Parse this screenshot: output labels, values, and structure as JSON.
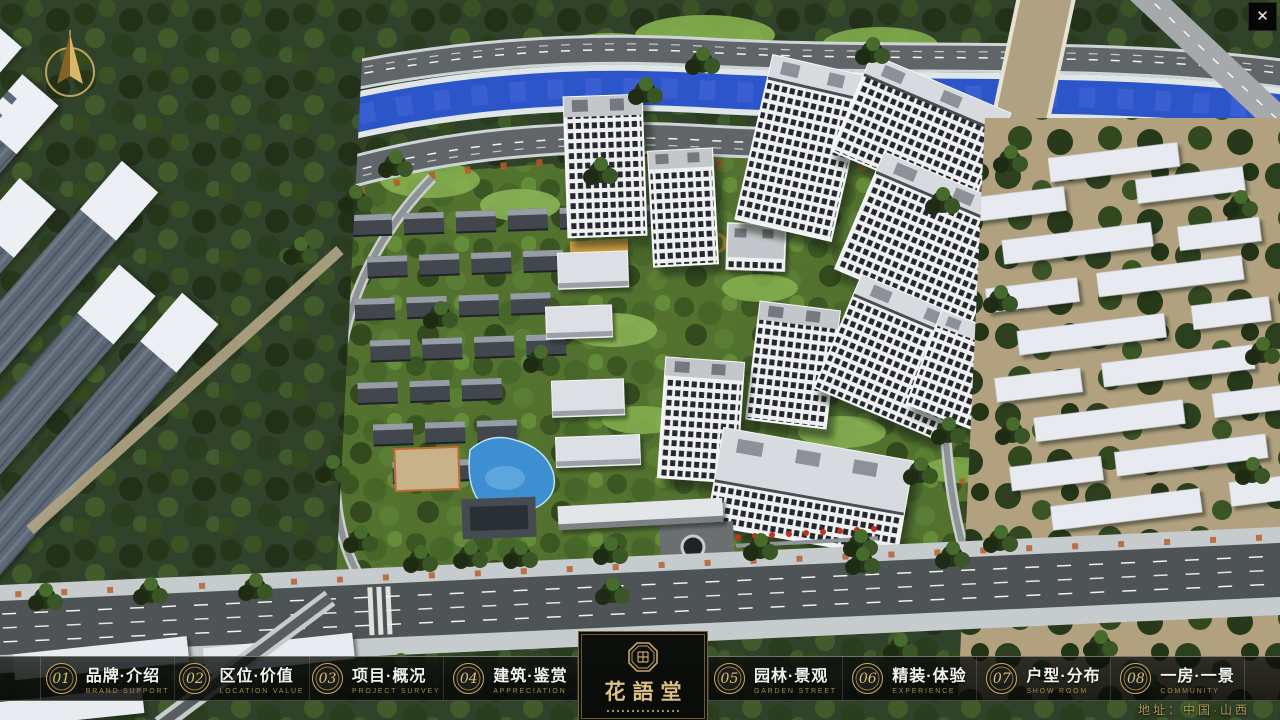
{
  "window": {
    "close_glyph": "✕"
  },
  "icons": {
    "close": "x-cross",
    "compass": "gold-north-needle",
    "seal": "octagon-seal"
  },
  "colors": {
    "accent_gold": "#c2a265",
    "nav_bar_bg": "rgba(10,13,11,0.82)",
    "river_blue": "#2b55c8",
    "logo_gold": "#dcc084",
    "address_gold": "#ab9258"
  },
  "nav": {
    "items": [
      {
        "num": "01",
        "zh": "品牌·介绍",
        "en": "BRAND SUPPORT"
      },
      {
        "num": "02",
        "zh": "区位·价值",
        "en": "LOCATION VALUE"
      },
      {
        "num": "03",
        "zh": "项目·概况",
        "en": "PROJECT SURVEY"
      },
      {
        "num": "04",
        "zh": "建筑·鉴赏",
        "en": "APPRECIATION"
      },
      {
        "num": "05",
        "zh": "园林·景观",
        "en": "GARDEN STREET"
      },
      {
        "num": "06",
        "zh": "精装·体验",
        "en": "EXPERIENCE"
      },
      {
        "num": "07",
        "zh": "户型·分布",
        "en": "SHOW ROOM"
      },
      {
        "num": "08",
        "zh": "一房·一景",
        "en": "COMMUNITY"
      }
    ]
  },
  "logo": {
    "title": "花語堂"
  },
  "footer": {
    "address": "地址：中国·山西"
  }
}
